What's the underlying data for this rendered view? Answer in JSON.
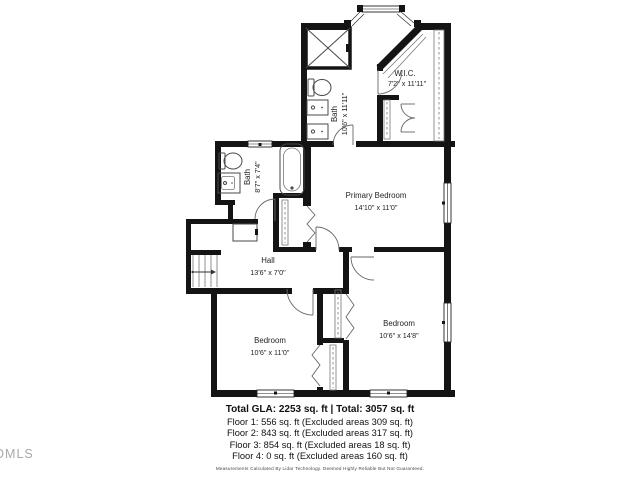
{
  "floorplan": {
    "rooms": [
      {
        "id": "bath-upper",
        "name": "Bath",
        "dims": "10'6\" x 11'11\""
      },
      {
        "id": "wic",
        "name": "W.I.C.",
        "dims": "7'2\" x 11'11\""
      },
      {
        "id": "bath-main",
        "name": "Bath",
        "dims": "8'7\" x 7'4\""
      },
      {
        "id": "primary-bedroom",
        "name": "Primary Bedroom",
        "dims": "14'10\" x 11'0\""
      },
      {
        "id": "hall",
        "name": "Hall",
        "dims": "13'6\" x 7'0\""
      },
      {
        "id": "bedroom-left",
        "name": "Bedroom",
        "dims": "10'6\" x 11'0\""
      },
      {
        "id": "bedroom-right",
        "name": "Bedroom",
        "dims": "10'6\" x 14'8\""
      }
    ]
  },
  "summary": {
    "total_line": "Total GLA: 2253 sq. ft | Total: 3057 sq. ft",
    "floor_lines": [
      "Floor 1: 556 sq. ft (Excluded areas 309 sq. ft)",
      "Floor 2: 843 sq. ft (Excluded areas 317 sq. ft)",
      "Floor 3: 854 sq. ft (Excluded areas 18 sq. ft)",
      "Floor 4: 0 sq. ft (Excluded areas 160 sq. ft)"
    ],
    "disclaimer": "Measurements Calculated By Lidar Technology. Deemed Highly Reliable But Not Guaranteed."
  },
  "watermark": "DMLS",
  "colors": {
    "wall": "#141414",
    "fixture": "#4a4a4a",
    "label": "#1f1f1f",
    "watermark": "#a8a8a8"
  }
}
